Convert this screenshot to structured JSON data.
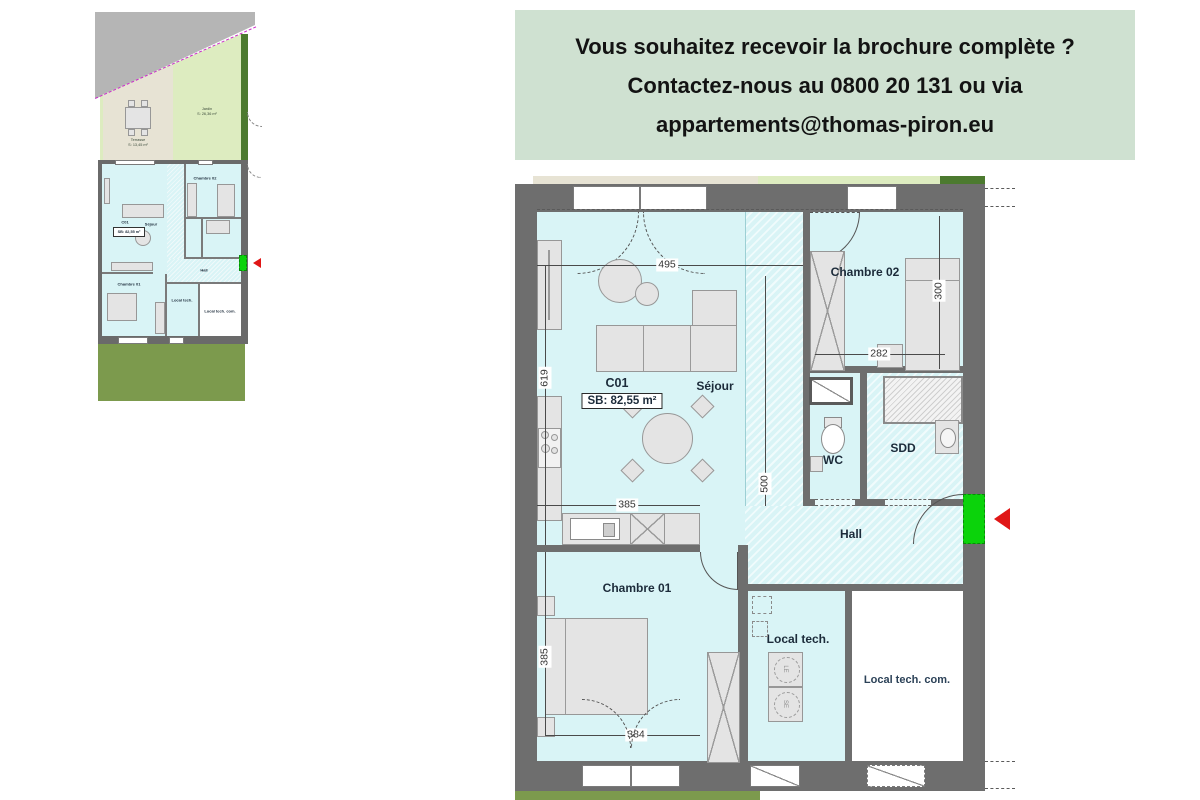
{
  "banner": {
    "line1": "Vous souhaitez recevoir la brochure complète ?",
    "line2": "Contactez-nous au 0800 20 131 ou via",
    "line3": "appartements@thomas-piron.eu"
  },
  "plan": {
    "unit_code": "C01",
    "unit_area": "SB: 82,55 m²",
    "rooms": {
      "sejour": "Séjour",
      "chambre02": "Chambre 02",
      "chambre01": "Chambre 01",
      "wc": "WC",
      "sdd": "SDD",
      "hall": "Hall",
      "local_tech": "Local tech.",
      "local_tech_com": "Local tech. com."
    },
    "dims": {
      "sejour_w": "495",
      "sejour_h": "619",
      "shaft_h": "500",
      "ch02_w": "282",
      "ch02_h": "300",
      "kitchen_w": "385",
      "ch01_h": "385",
      "ch01_w": "384"
    },
    "appliances": {
      "a1": "LE",
      "a2": "SE"
    }
  },
  "mini_plan": {
    "unit_code": "C01",
    "unit_area": "SB: 82,55 m²",
    "labels": {
      "jardin": "Jardin",
      "jardin_area": "S: 26,36 m²",
      "terrasse": "Terrasse",
      "terrasse_area": "S: 13,45 m²",
      "sejour": "Séjour",
      "chambre02": "Chambre 02",
      "chambre01": "Chambre 01",
      "hall": "Hall",
      "local_tech": "Local tech.",
      "local_tech_com": "Local tech. com."
    }
  },
  "colors": {
    "banner_bg": "#cfe1d1",
    "floor_cyan": "#d9f4f6",
    "wall_gray": "#6e6e6e",
    "door_green": "#0bd30b",
    "arrow_red": "#e01616",
    "garden_green": "#ddecc0",
    "terrace_beige": "#e7e3d4",
    "grass_olive": "#7c9a4d",
    "hedge_dark_green": "#4c7a2f",
    "road_gray": "#b5b5b5",
    "boundary_magenta": "#cc2bcc"
  }
}
